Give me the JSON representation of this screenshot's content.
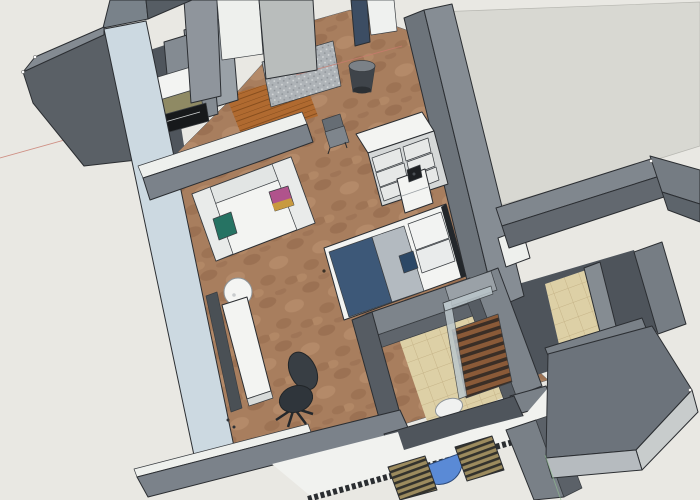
{
  "colors": {
    "bg": "#e9e8e3",
    "area": "#d8d8d2",
    "axis_red": "#c97b6e",
    "axis_green": "#8fbb8f",
    "wall_mid": "#848b92",
    "wall_mid2": "#7b828a",
    "wall_light": "#9aa1a7",
    "wall_dark": "#5a6066",
    "wall_darker": "#4f555c",
    "wall_face": "#6d747b",
    "wall_blue": "#ccd9e1",
    "white_strip": "#eef0ed",
    "area_wall": "#868d94",
    "floor_wood": "#a87e5e",
    "wood_dark": "#8d6245",
    "wood_light": "#c09573",
    "plank": "#b06a30",
    "plank_line": "#7a4418",
    "tile": "#ddd0a6",
    "tile_line": "#c6b488",
    "floor_dark": "#4e545b",
    "balcony": "#f1f2ef",
    "white": "#f3f4f2",
    "white_shade": "#e2e5e4",
    "white_dim": "#d5d8d8",
    "bed_navy": "#3d5878",
    "bed_gray": "#b3bac0",
    "navy_dark": "#2c4866",
    "teal": "#267363",
    "pink": "#b0538c",
    "accent": "#c89a3f",
    "chair": "#383e44",
    "chair_dark": "#24282c",
    "blue_table": "#5a8ad6",
    "lounger": "#9c8b5e",
    "lounger_dark": "#33322c",
    "shower_wood": "#8a5a38",
    "shower_dark": "#3a2e26",
    "glass": "#bcc7cc",
    "stove": "#17191b",
    "olive": "#8f8a64",
    "mat": "#aeb3b7",
    "mat_dot": "#d6d9da",
    "navy_col": "#3c4d63",
    "slab": "#6c737b",
    "slab_face": "#c8cccc",
    "slab_face2": "#b6bbbf",
    "outline": "#2b2e32"
  }
}
